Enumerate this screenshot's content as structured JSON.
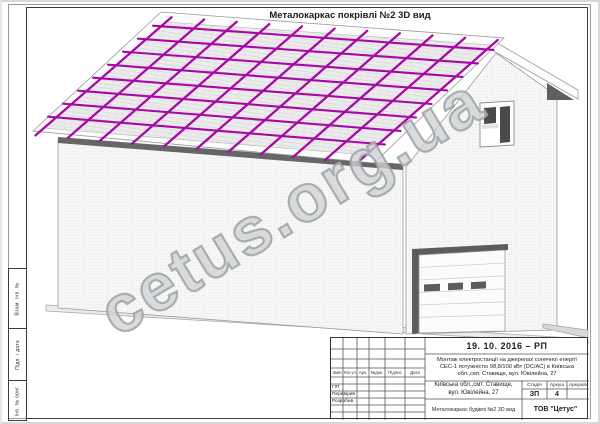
{
  "page": {
    "title": "Металокаркас покрівлі №2 3D вид",
    "watermark": "cetus.org.ua"
  },
  "margin_stamps": [
    {
      "label": "Взам. інв. №"
    },
    {
      "label": "Підп. і дата"
    },
    {
      "label": "Інв. № ориг."
    }
  ],
  "title_block": {
    "date_code": "19. 10. 2016 – РП",
    "project_description": "Монтаж електростанції на джерелах сонячної енергії СЕС-1 потужністю 98,8/100 кВт (DC/AC) в Київська обл.,смт. Ставище, вул. Ювілейна, 27",
    "object_address": "Київська обл.,смт. Ставище, вул. Ювілейна, 27",
    "sheet_title": "Металокаркас будівлі №2 3D вид",
    "company": "ТОВ \"Цетус\"",
    "stage_header": "Стадія",
    "sheet_header": "Аркуш",
    "sheets_header": "Аркушів",
    "stage_value": "ЗП",
    "sheet_value": "4",
    "sheets_value": "",
    "rev_headers": [
      "Змін",
      "Кіл.уч",
      "Арк.",
      "№док.",
      "Підпис",
      "Дата"
    ],
    "roles": [
      "ГІП",
      "Перевірив",
      "Розробив"
    ]
  },
  "drawing": {
    "roof_grid": {
      "rafter_count": 11,
      "purlin_count": 8,
      "color": "#A708A7"
    },
    "colors": {
      "roof_fill": "#ededed",
      "wall_fill": "#f6f6f6",
      "fascia_fill": "#fdfdfd",
      "shadow_dark": "#5f5f5f",
      "outline": "#9a9a9a"
    }
  }
}
